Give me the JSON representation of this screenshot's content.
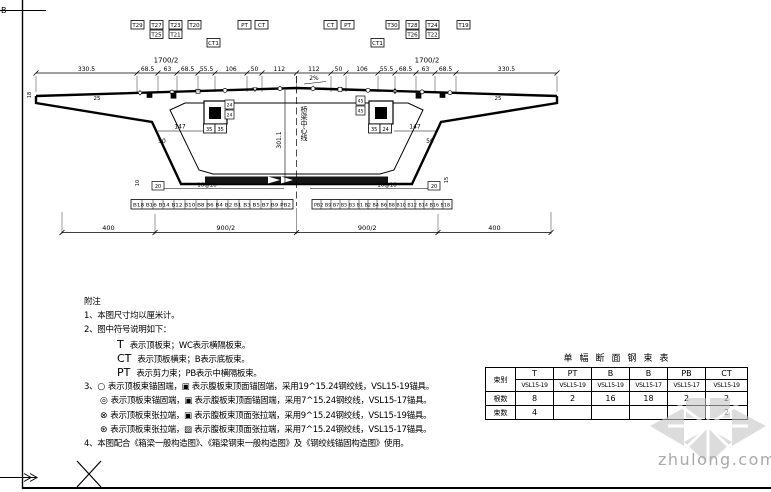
{
  "watermark": {
    "text": "zhulong.com"
  },
  "frame": {
    "top_mark": "B"
  },
  "drawing": {
    "half_width_label": "1700/2",
    "top_chain": [
      "330.5",
      "68.5",
      "63",
      "68.5",
      "55.5",
      "106",
      "50",
      "112",
      "112",
      "50",
      "106",
      "55.5",
      "68.5",
      "63",
      "68.5",
      "330.5"
    ],
    "bottom_chain": [
      "400",
      "900/2",
      "900/2",
      "400"
    ],
    "girder_height": "301.1",
    "slope_label": "2%",
    "centerline_label": "桥梁中心线",
    "web_offset": "147",
    "web_width": "50",
    "tip_thickness": "18",
    "wing_dim": "25",
    "block_dims_left": [
      "35",
      "35"
    ],
    "block_dims_right": [
      "35",
      "24"
    ],
    "side_dims_left": [
      "24",
      "24"
    ],
    "side_dims_right": [
      "45",
      "45"
    ],
    "bottom_spacing": "16@18",
    "bottom_edge": "20",
    "bottom_left_thickness": "10",
    "bottom_right_thickness": "15",
    "top_labels_left": [
      "T29",
      "T27",
      "T25",
      "T23",
      "T21",
      "T20",
      "CT1",
      "PT",
      "CT"
    ],
    "top_labels_right": [
      "CT",
      "PT",
      "CT1",
      "T30",
      "T28",
      "T26",
      "T24",
      "T22",
      "T19"
    ],
    "bottom_strip_left": "B18 B16 B14 B12 B10 B8 B6 B4 B2 B1 B3 B5 B7 B9 PB2",
    "bottom_strip_right": "PB2 B9 B7 B5 B3 B1 B2 B4 B6 B8 B10 B12 B14 B16 B18"
  },
  "notes": {
    "title": "附注",
    "n1": "1、本图尺寸均以厘米计。",
    "n2": "2、图中符号说明如下：",
    "t_sym": "T",
    "t_text": "表示顶板束；WC表示横隔板束。",
    "ct_sym": "CT",
    "ct_text": "表示顶板横束；B表示底板束。",
    "pt_sym": "PT",
    "pt_text": "表示剪力束；PB表示中横隔板束。",
    "n3_prefix": "3、",
    "s1": "○",
    "s1_text": "表示顶板束锚固端，▣ 表示腹板束顶面锚固端，采用19^15.24钢绞线，VSL15-19锚具。",
    "s2": "◎",
    "s2_text": "表示顶板束锚固端，▣ 表示腹板束顶面锚固端，采用7^15.24钢绞线，VSL15-17锚具。",
    "s3": "⊗",
    "s3_text": "表示顶板束张拉端，▣ 表示腹板束顶面张拉端，采用9^15.24钢绞线，VSL15-19锚具。",
    "s4": "⊛",
    "s4_text": "表示顶板束张拉端，▨ 表示腹板束顶面张拉端，采用7^15.24钢绞线，VSL15-17锚具。",
    "n4": "4、本图配合《箱梁一般构造图》、《箱梁钢束一般构造图》及《钢绞线锚固构造图》使用。"
  },
  "table": {
    "title": "单幅断面钢束表",
    "corner": "束别",
    "columns": [
      "T",
      "PT",
      "B",
      "B",
      "PB",
      "CT"
    ],
    "anchors": [
      "VSL15-19",
      "VSL15-19",
      "VSL15-19",
      "VSL15-17",
      "VSL15-17",
      "VSL15-19"
    ],
    "row1_label": "根数",
    "row1": [
      "8",
      "2",
      "16",
      "18",
      "2",
      "2"
    ],
    "row2_label": "束数",
    "row2": [
      "4",
      "",
      "",
      "",
      "",
      "2"
    ]
  }
}
